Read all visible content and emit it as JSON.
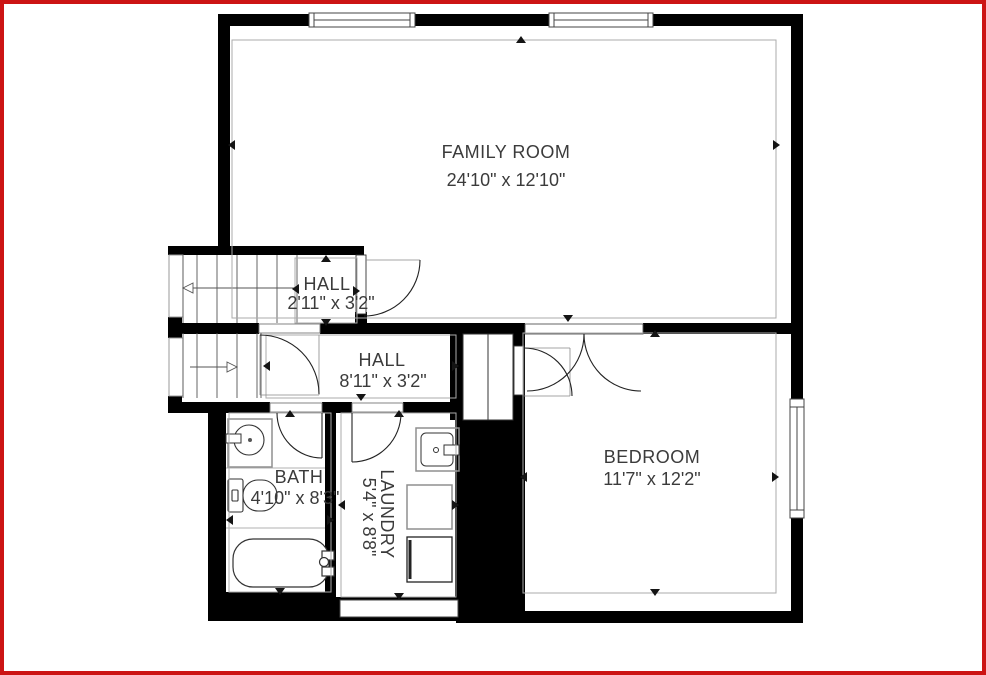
{
  "plan": {
    "type": "floor-plan",
    "border_color": "#cc1414",
    "wall_color": "#000000",
    "text_color": "#3b3b3b",
    "dim_line_color": "#ababab",
    "fixture_line_color": "#8f8f8f",
    "rooms": {
      "family_room": {
        "label": "FAMILY ROOM",
        "dims": "24'10\" x 12'10\""
      },
      "hall_upper": {
        "label": "HALL",
        "dims": "2'11\" x 3'2\""
      },
      "hall_lower": {
        "label": "HALL",
        "dims": "8'11\" x 3'2\""
      },
      "bath": {
        "label": "BATH",
        "dims": "4'10\" x 8'3\""
      },
      "laundry": {
        "label": "LAUNDRY",
        "dims": "5'4\" x 8'8\""
      },
      "bedroom": {
        "label": "BEDROOM",
        "dims": "11'7\" x 12'2\""
      }
    }
  }
}
